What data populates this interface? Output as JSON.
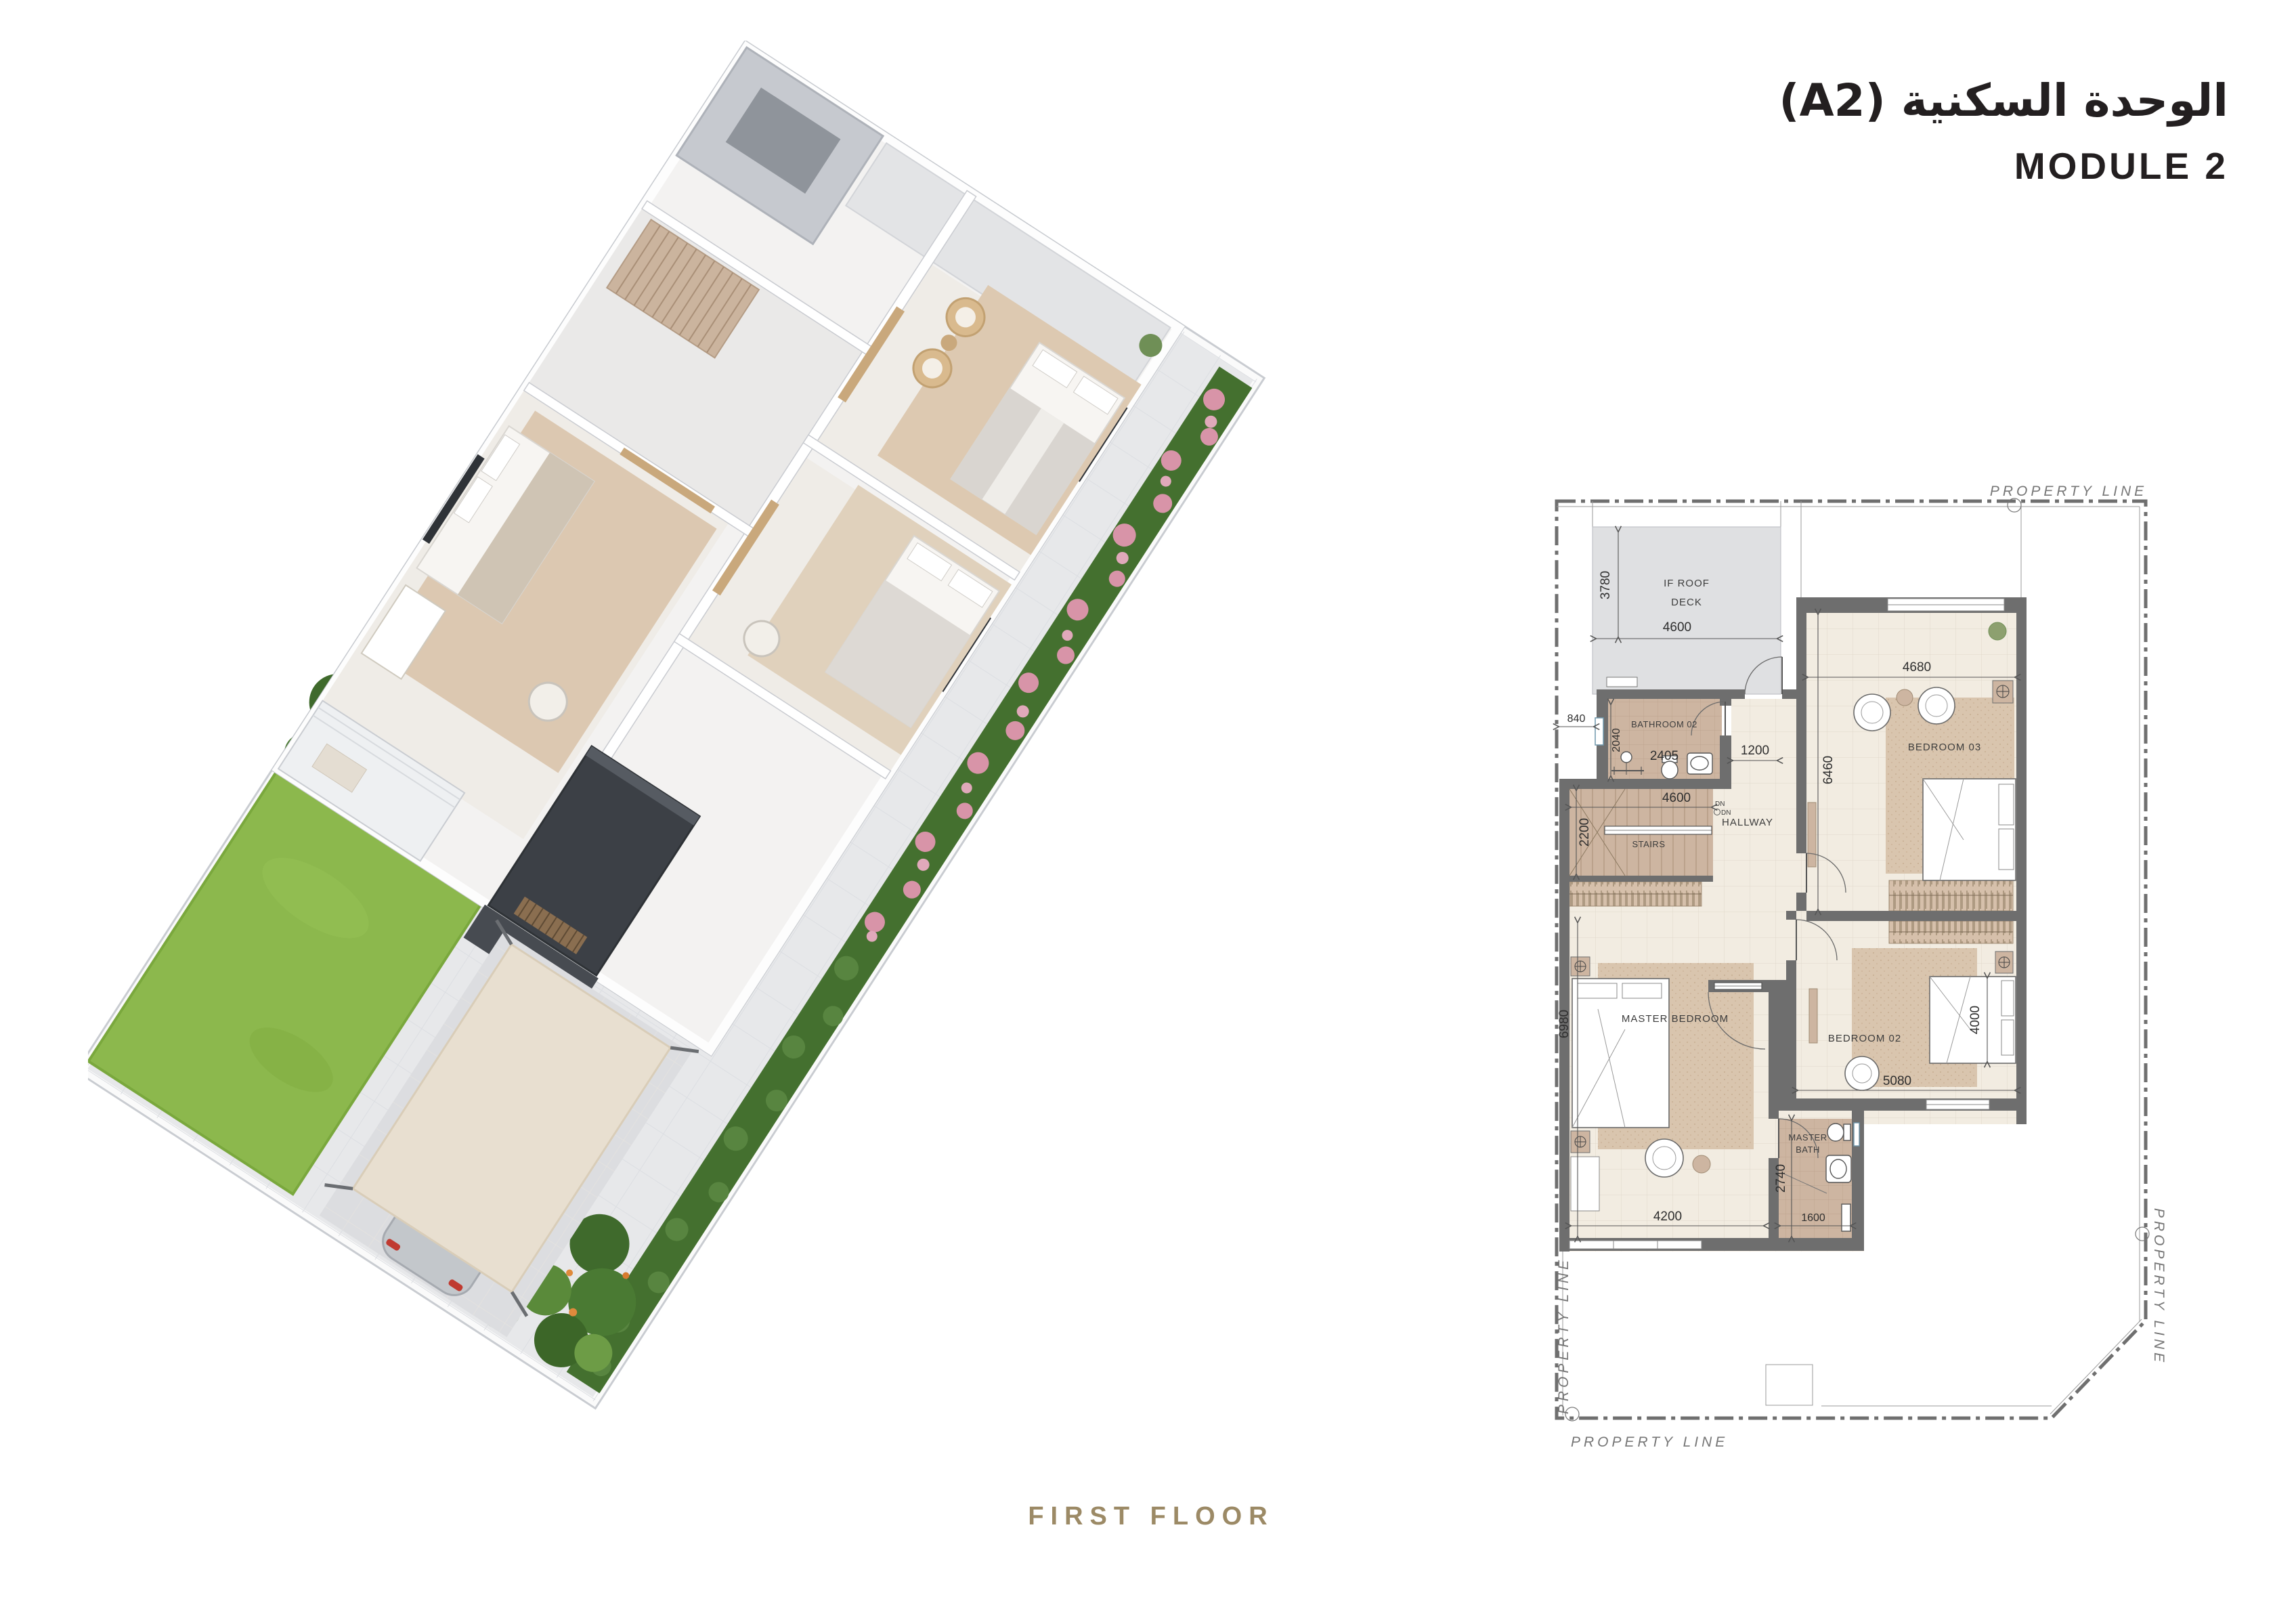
{
  "header": {
    "title_ar": "الوحدة السكنية (A2)",
    "title_en": "MODULE 2"
  },
  "footer": {
    "label": "FIRST FLOOR"
  },
  "plan": {
    "boundary": {
      "label": "PROPERTY LINE"
    },
    "rooms": {
      "roof_deck": {
        "line1": "IF ROOF",
        "line2": "DECK",
        "w": "4600",
        "h": "3780"
      },
      "bathroom02": {
        "name": "BATHROOM 02",
        "w": "2405",
        "h": "2040",
        "setback": "840"
      },
      "hallway": {
        "name": "HALLWAY",
        "w": "1200",
        "dn": "DN"
      },
      "stairs": {
        "name": "STAIRS",
        "w": "4600",
        "h": "2200"
      },
      "bedroom03": {
        "name": "BEDROOM 03",
        "w": "4680",
        "h": "6460"
      },
      "bedroom02": {
        "name": "BEDROOM 02",
        "w": "5080",
        "bed_w": "4000"
      },
      "master_bedroom": {
        "name": "MASTER BEDROOM",
        "w": "4200",
        "h": "6980"
      },
      "master_bath": {
        "line1": "MASTER",
        "line2": "BATH",
        "w": "1600",
        "h": "2740"
      }
    },
    "colors": {
      "wall": "#6e6e6e",
      "floor": "#f1ebe1",
      "tile_tan": "#cdb5a1",
      "deck": "#dfe0e2",
      "rug": "#d9c5ae",
      "text": "#3c3c3c"
    }
  },
  "render3d": {
    "colors": {
      "lawn": "#8cb84d",
      "hedge": "#44702f",
      "flowers": "#dd9cae",
      "paving": "#e7e8ea",
      "walls": "#ffffff",
      "dark_volume": "#3c4046",
      "canopy": "#e8dfd0",
      "car": "#c3c7cb",
      "accent_gold": "#9c8a66"
    }
  }
}
